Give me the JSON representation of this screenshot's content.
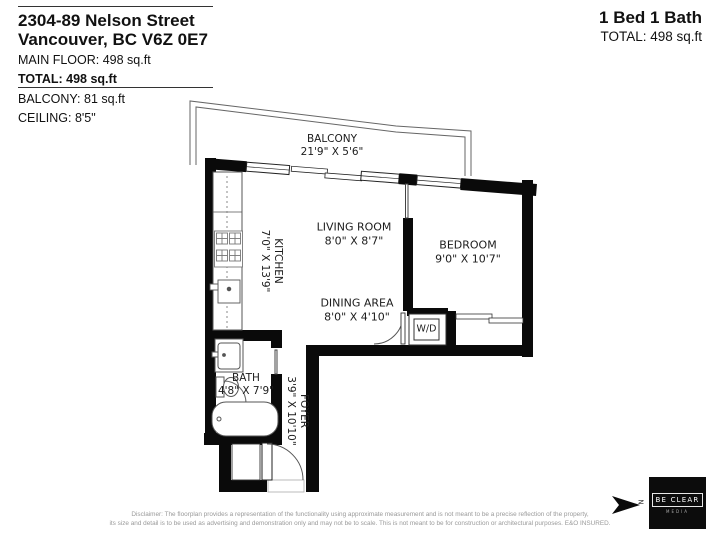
{
  "header": {
    "address_line1": "2304-89 Nelson Street",
    "address_line2": "Vancouver, BC V6Z 0E7",
    "main_floor": "MAIN FLOOR: 498 sq.ft",
    "total": "TOTAL: 498 sq.ft",
    "balcony_area": "BALCONY: 81 sq.ft",
    "ceiling": "CEILING: 8'5\""
  },
  "summary": {
    "beds_baths": "1 Bed 1 Bath",
    "total": "TOTAL: 498 sq.ft"
  },
  "rooms": {
    "balcony": {
      "name": "BALCONY",
      "dims": "21'9\" X 5'6\""
    },
    "living": {
      "name": "LIVING ROOM",
      "dims": "8'0\" X 8'7\""
    },
    "dining": {
      "name": "DINING AREA",
      "dims": "8'0\" X 4'10\""
    },
    "kitchen": {
      "name": "KITCHEN",
      "dims": "7'0\" X 13'9\""
    },
    "bedroom": {
      "name": "BEDROOM",
      "dims": "9'0\" X 10'7\""
    },
    "bath": {
      "name": "BATH",
      "dims": "4'8\" X 7'9\""
    },
    "foyer": {
      "name": "FOYER",
      "dims": "3'9\" X 10'10\""
    },
    "wd": {
      "name": "W/D"
    }
  },
  "footer": {
    "disclaimer_line1": "Disclaimer: The floorplan provides a representation of the functionality using approximate measurement and is not meant to be a precise reflection of the property,",
    "disclaimer_line2": "its size and detail is to be used as advertising and demonstration only and may not be to scale. This is not meant to be for construction or architectural purposes. E&O INSURED.",
    "north_letter": "N",
    "logo_line1": "BE CLEAR",
    "logo_line2": "MEDIA"
  },
  "colors": {
    "wall": "#0a0a0a",
    "outline": "#555555",
    "text": "#1c1c1c"
  }
}
